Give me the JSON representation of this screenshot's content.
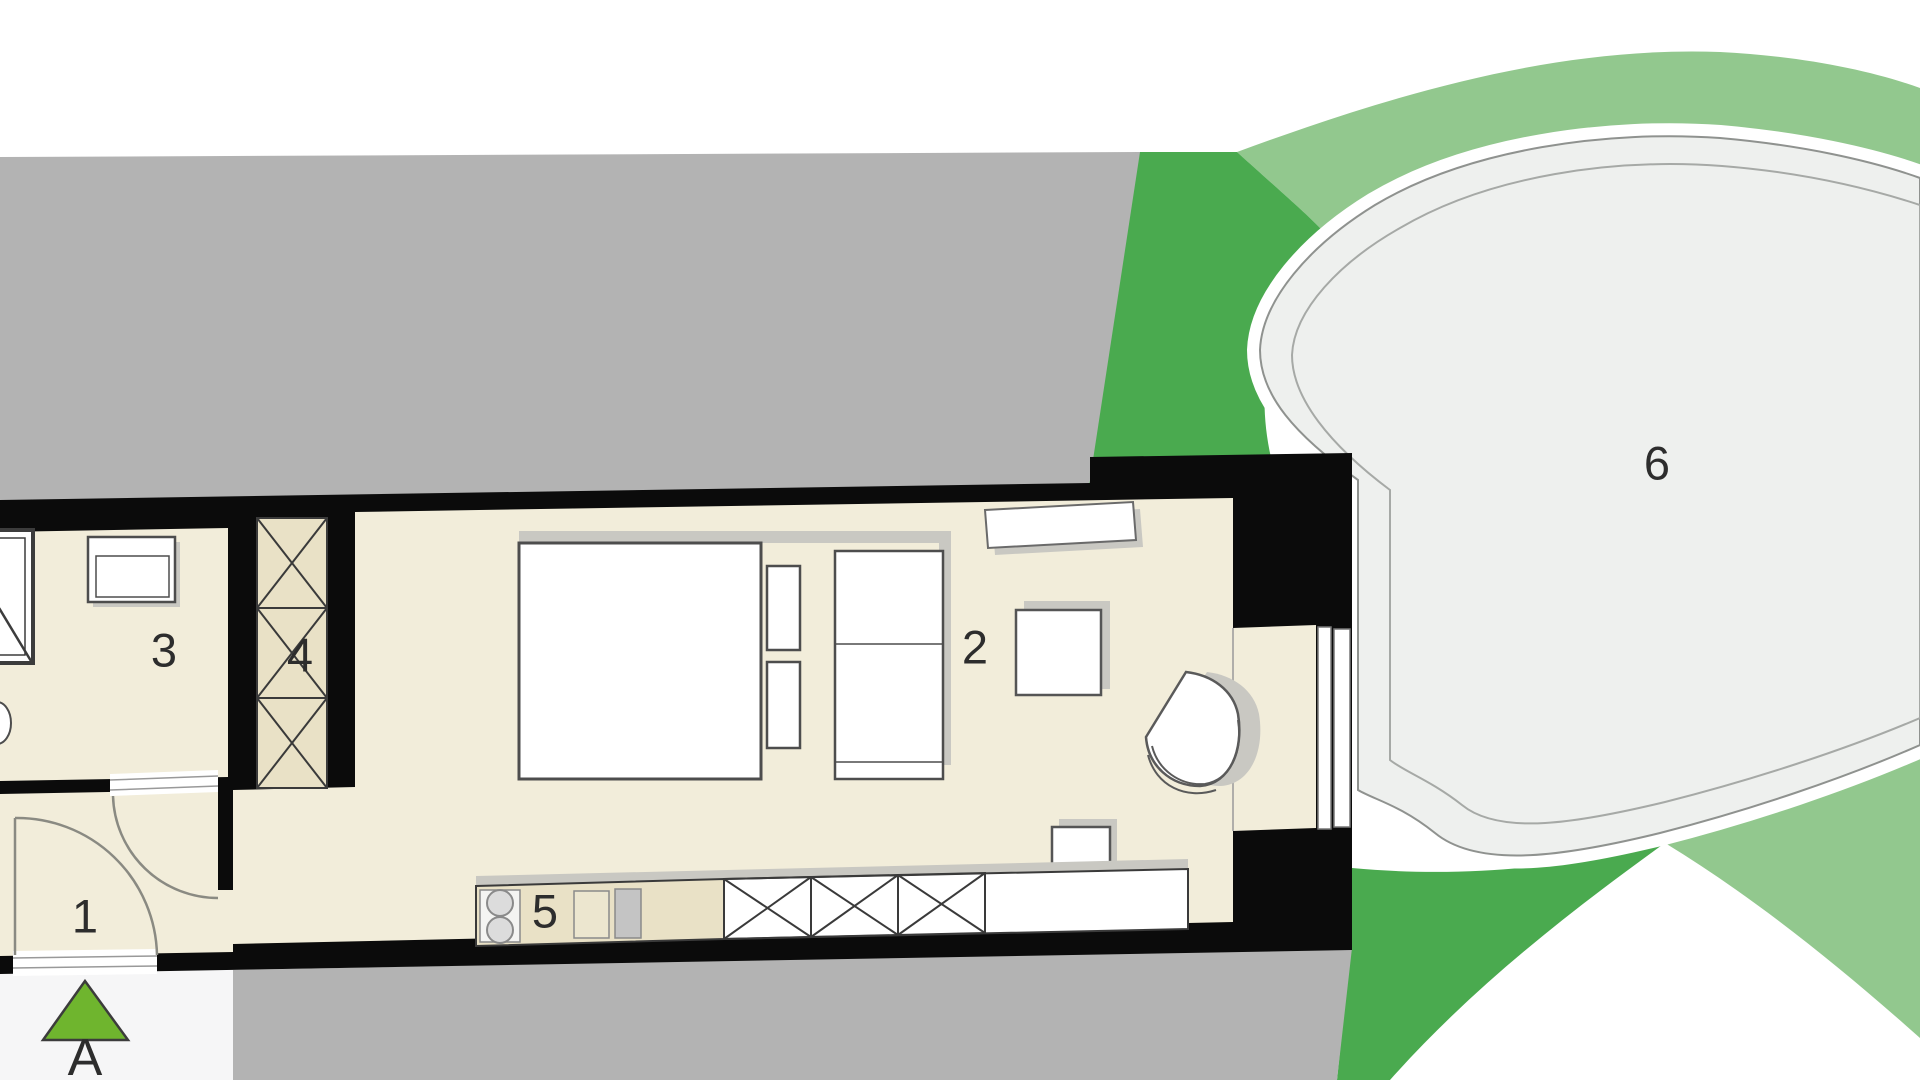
{
  "plan": {
    "labels": {
      "entrance": "1",
      "main_room": "2",
      "bathroom": "3",
      "wardrobe": "4",
      "kitchen": "5",
      "garden": "6"
    },
    "section_marker": {
      "label": "A"
    },
    "palette": {
      "floor_cream": "#f2edda",
      "cabinet_beige": "#e9e1c6",
      "walls_black": "#0b0b0b",
      "neighbor_gray": "#b3b3b3",
      "lawn_dark_green": "#4aaa4f",
      "lawn_light_green": "#92c88e",
      "garden_ellipse_fill": "#eef0ee",
      "garden_ellipse_stroke": "#8f928f",
      "section_marker_green": "#6fb52e",
      "furniture_shadow": "#c9c8c2"
    }
  }
}
